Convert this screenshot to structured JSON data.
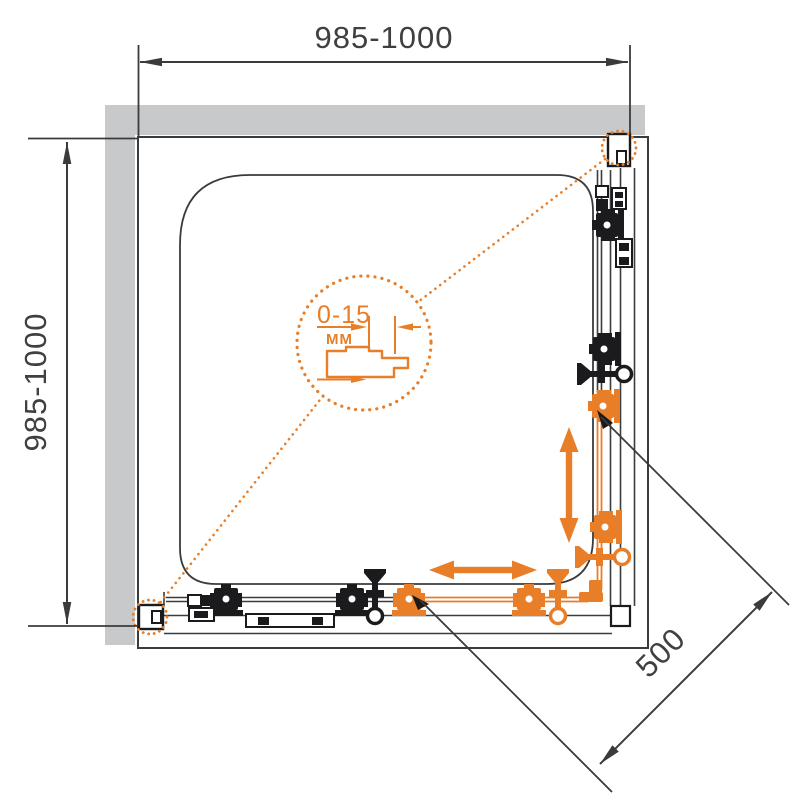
{
  "drawing": {
    "description": "Top-view installation diagram of a square corner shower enclosure with sliding doors",
    "dimension_top_label": "985-1000",
    "dimension_left_label": "985-1000",
    "dimension_diagonal_label": "500",
    "detail_adjustment_label": "0-15",
    "detail_unit_label": "MM",
    "colors": {
      "accent_orange": "#E87E28",
      "wall_gray": "#C8C9CB",
      "line_dark": "#3A3B3D",
      "hardware_black": "#1B1B1D"
    }
  }
}
